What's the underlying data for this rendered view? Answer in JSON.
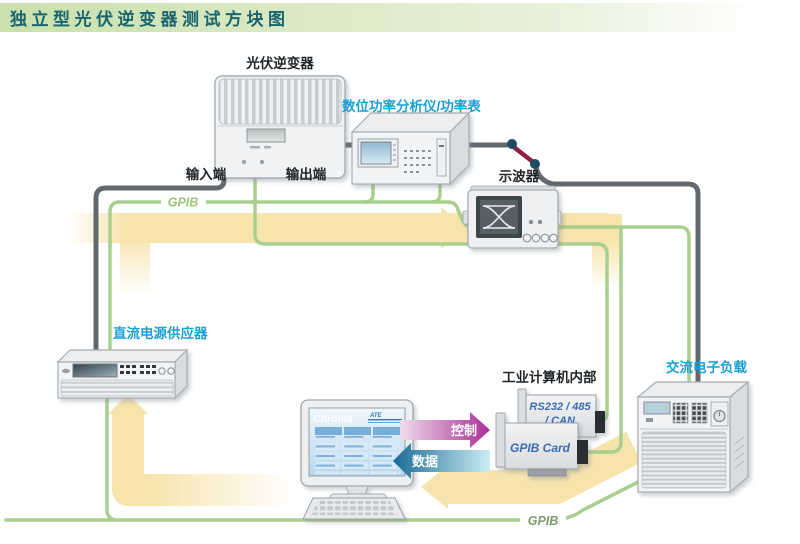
{
  "title": "独立型光伏逆变器测试方块图",
  "colors": {
    "title_text": "#1a646e",
    "title_bar_green": "#cbe1ad",
    "label_black": "#1f2326",
    "label_cyan": "#1ba0d4",
    "gpib_green_top": "#9cc479",
    "gpib_green_bottom": "#7e9b6e",
    "wire_gray": "#63686d",
    "wire_green": "#a8cf8e",
    "band_yellow": "#f7e4ad",
    "switch_dot": "#1e4c60",
    "switch_blade": "#8e2045",
    "control_magenta": "#a92e95",
    "data_blue": "#1a6a96",
    "card_text_blue": "#3b6cb4"
  },
  "nodes": {
    "pv_inverter": {
      "label": "光伏逆变器"
    },
    "power_analyzer": {
      "label": "数位功率分析仪/功率表"
    },
    "oscilloscope": {
      "label": "示波器"
    },
    "dc_power_supply": {
      "label": "直流电源供应器"
    },
    "ac_electronic_load": {
      "label": "交流电子负载"
    },
    "industrial_pc": {
      "label": "工业计算机内部",
      "rs232_card": {
        "line1": "RS232 / 485",
        "line2": "/ CAN"
      },
      "gpib_card": {
        "label": "GPIB Card"
      }
    },
    "pc_monitor": {
      "brand": "Chroma",
      "logo_small": "ATE"
    }
  },
  "wires": {
    "input_terminal": "输入端",
    "output_terminal": "输出端",
    "gpib_top": "GPIB",
    "gpib_bottom": "GPIB"
  },
  "flows": {
    "control": "控制",
    "data": "数据"
  }
}
